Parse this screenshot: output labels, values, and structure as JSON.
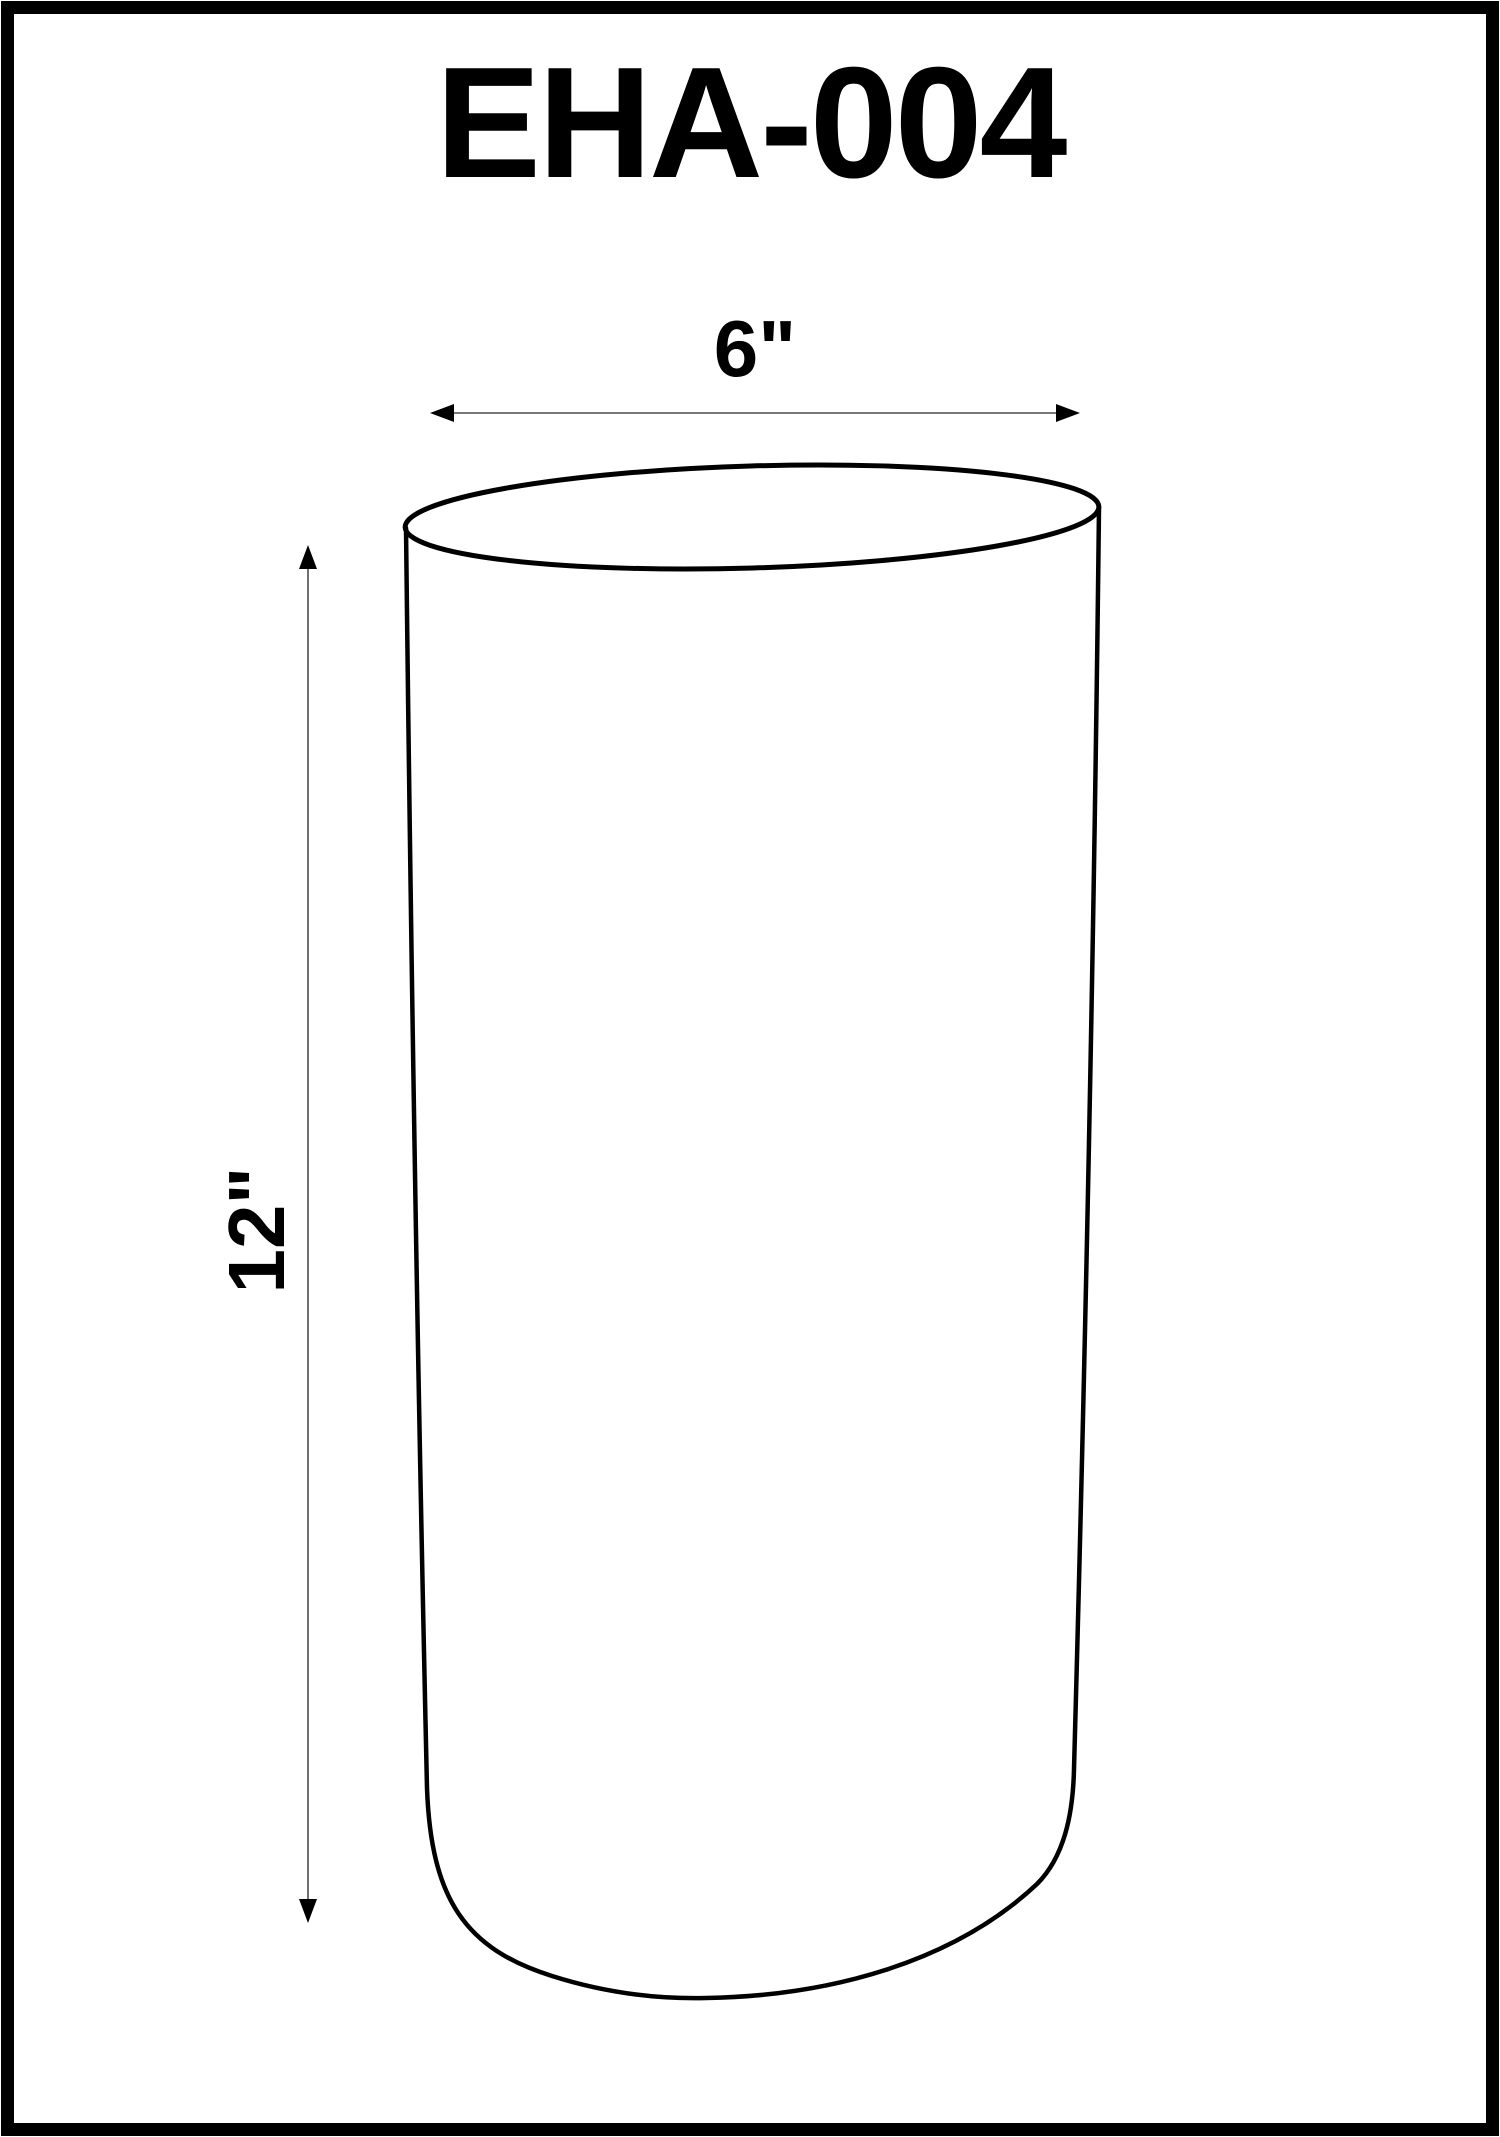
{
  "page": {
    "title": "EHA-004"
  },
  "dimensions": {
    "width_label": "6\"",
    "height_label": "12\""
  },
  "colors": {
    "ink": "#000000",
    "background": "#ffffff",
    "dimension_line": "#4d4d4d"
  }
}
